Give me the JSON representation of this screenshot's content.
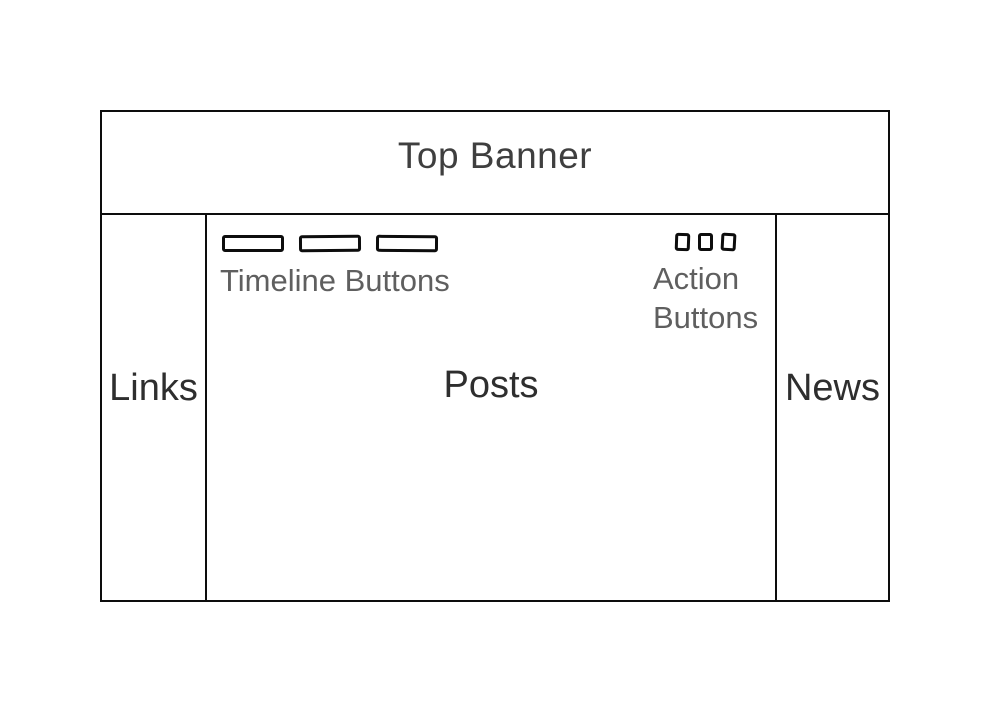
{
  "colors": {
    "line": "#0d0d0d",
    "banner_text": "#3f3f3f",
    "section_text": "#2e2e2e",
    "caption_text": "#5f5f5f",
    "bg": "#ffffff"
  },
  "banner": {
    "label": "Top Banner"
  },
  "sidebar_left": {
    "label": "Links"
  },
  "main": {
    "label": "Posts",
    "timeline": {
      "label": "Timeline Buttons",
      "button_count": 3
    },
    "actions": {
      "label_line1": "Action",
      "label_line2": "Buttons",
      "button_count": 3
    }
  },
  "sidebar_right": {
    "label": "News"
  }
}
